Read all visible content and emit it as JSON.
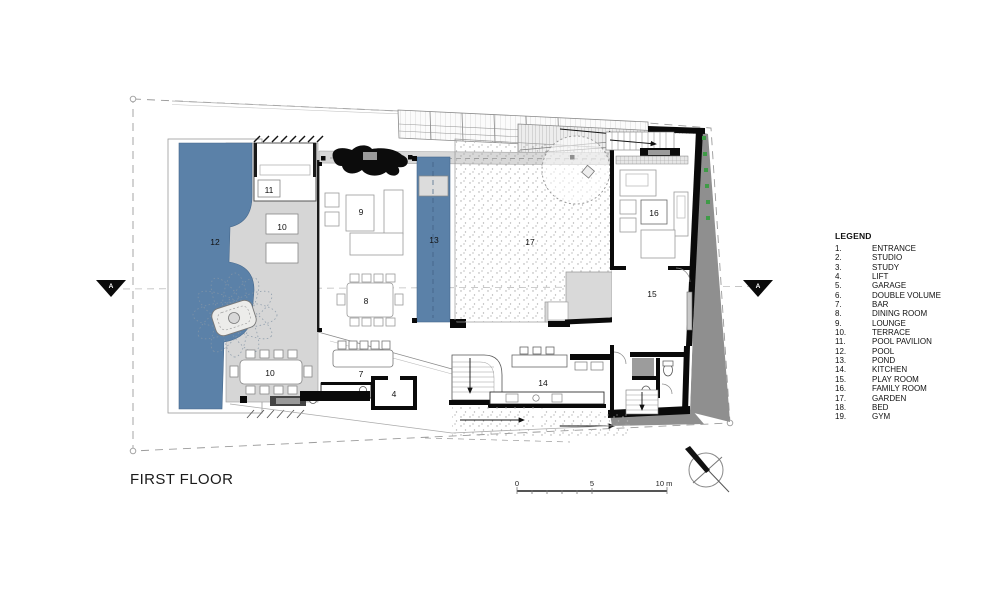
{
  "title": "FIRST FLOOR",
  "legend": {
    "header": "LEGEND",
    "items": [
      {
        "num": "1.",
        "name": "ENTRANCE"
      },
      {
        "num": "2.",
        "name": "STUDIO"
      },
      {
        "num": "3.",
        "name": "STUDY"
      },
      {
        "num": "4.",
        "name": "LIFT"
      },
      {
        "num": "5.",
        "name": "GARAGE"
      },
      {
        "num": "6.",
        "name": "DOUBLE VOLUME"
      },
      {
        "num": "7.",
        "name": "BAR"
      },
      {
        "num": "8.",
        "name": "DINING ROOM"
      },
      {
        "num": "9.",
        "name": "LOUNGE"
      },
      {
        "num": "10.",
        "name": "TERRACE"
      },
      {
        "num": "11.",
        "name": "POOL PAVILION"
      },
      {
        "num": "12.",
        "name": "POOL"
      },
      {
        "num": "13.",
        "name": "POND"
      },
      {
        "num": "14.",
        "name": "KITCHEN"
      },
      {
        "num": "15.",
        "name": "PLAY ROOM"
      },
      {
        "num": "16.",
        "name": "FAMILY ROOM"
      },
      {
        "num": "17.",
        "name": "GARDEN"
      },
      {
        "num": "18.",
        "name": "BED"
      },
      {
        "num": "19.",
        "name": "GYM"
      }
    ]
  },
  "plan": {
    "room_labels": [
      {
        "text": "12",
        "room": "POOL"
      },
      {
        "text": "11",
        "room": "POOL PAVILION"
      },
      {
        "text": "10",
        "room": "TERRACE"
      },
      {
        "text": "9",
        "room": "LOUNGE"
      },
      {
        "text": "8",
        "room": "DINING ROOM"
      },
      {
        "text": "13",
        "room": "POND"
      },
      {
        "text": "17",
        "room": "GARDEN"
      },
      {
        "text": "16",
        "room": "FAMILY ROOM"
      },
      {
        "text": "15",
        "room": "PLAY ROOM"
      },
      {
        "text": "10",
        "room": "TERRACE"
      },
      {
        "text": "7",
        "room": "BAR"
      },
      {
        "text": "14",
        "room": "KITCHEN"
      },
      {
        "text": "4",
        "room": "LIFT"
      }
    ],
    "section_marker": "A",
    "scale": {
      "start": "0",
      "mid": "5",
      "end": "10 m"
    }
  },
  "colors": {
    "water": "#5b81a8",
    "terrace_gray": "#d6d6d6",
    "shadow_gray": "#8f8f8f",
    "wall_black": "#0a0a0a",
    "plant_green": "#3f9b47"
  }
}
